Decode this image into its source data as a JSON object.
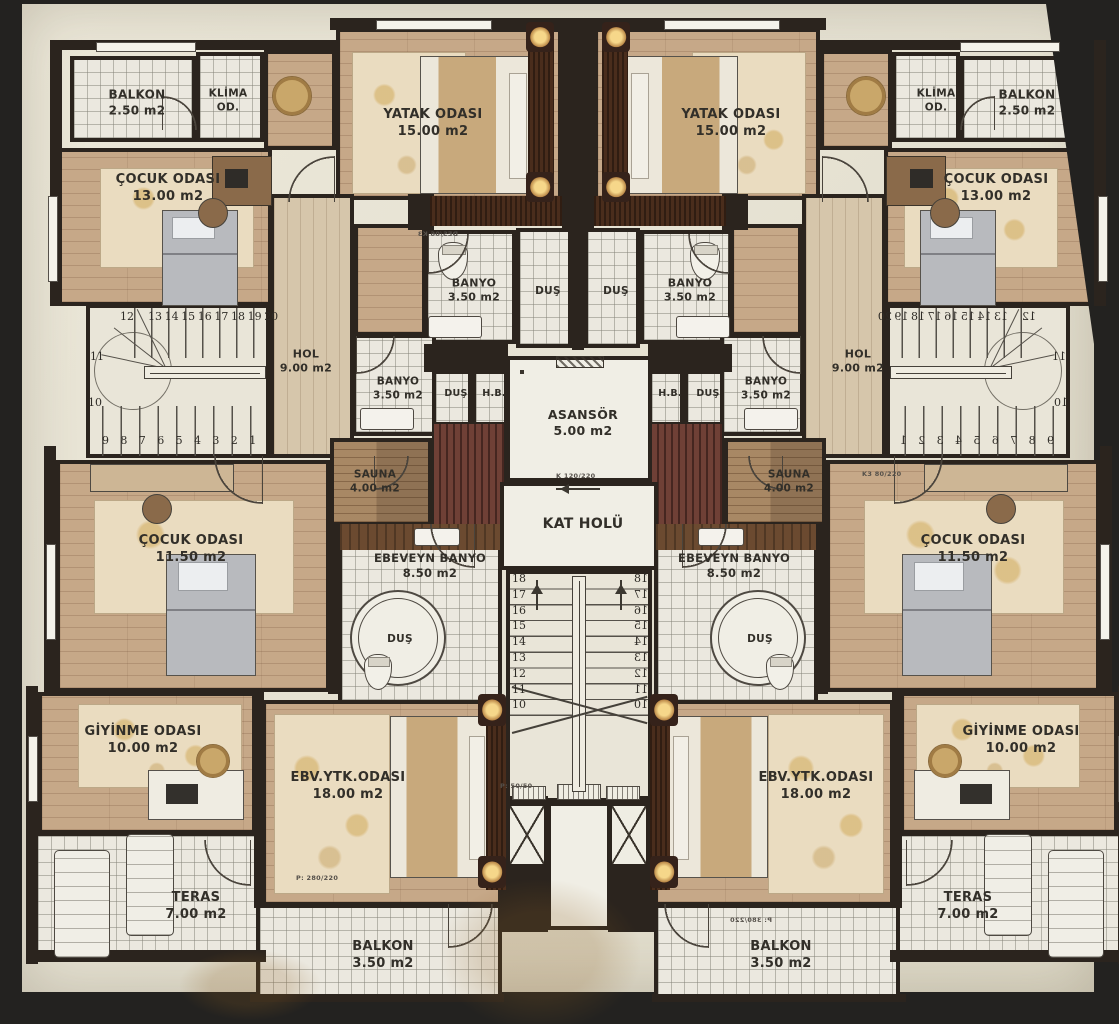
{
  "title": "Apartman Kat Planı (Duplex Floor Plan)",
  "colors": {
    "background": "#232220",
    "paper": "#e6e2d3",
    "wall": "#2b241e",
    "wood_floor": "#c6a888",
    "tile_floor": "#ebe8df",
    "entry_carpet": "#6f4036",
    "rug": "#eadcc0"
  },
  "plan": {
    "rooms": [
      {
        "id": "yatak-odasi",
        "side": "b",
        "lines": [
          "YATAK ODASI",
          "15.00 m2"
        ],
        "x": 336,
        "y": 28,
        "w": 226,
        "h": 172,
        "f": "wood",
        "ldx": -20,
        "ldy": 6
      },
      {
        "id": "wood-nook",
        "side": "b",
        "lines": [],
        "x": 264,
        "y": 50,
        "w": 72,
        "h": 100,
        "f": "wood"
      },
      {
        "id": "balkon-ust",
        "side": "b",
        "lines": [
          "BALKON",
          "2.50 m2"
        ],
        "x": 70,
        "y": 56,
        "w": 126,
        "h": 86,
        "f": "tile",
        "fs": 12
      },
      {
        "id": "klima-odasi",
        "side": "b",
        "lines": [
          "KLİMA",
          "OD."
        ],
        "x": 196,
        "y": 52,
        "w": 68,
        "h": 90,
        "f": "tile",
        "fs": 10.5,
        "ldx": -6
      },
      {
        "id": "cocuk-odasi-13",
        "side": "b",
        "lines": [
          "ÇOCUK ODASI",
          "13.00 m2"
        ],
        "x": 56,
        "y": 148,
        "w": 216,
        "h": 158,
        "f": "wood",
        "ldy": -42
      },
      {
        "id": "hol",
        "side": "b",
        "lines": [
          "HOL",
          "9.00 m2"
        ],
        "x": 270,
        "y": 194,
        "w": 84,
        "h": 264,
        "f": "woodv",
        "fs": 11,
        "ldx": -10,
        "ldy": 32
      },
      {
        "id": "wood-pass",
        "side": "b",
        "lines": [],
        "x": 354,
        "y": 224,
        "w": 72,
        "h": 112,
        "f": "wood"
      },
      {
        "id": "merdiven",
        "side": "b",
        "lines": [],
        "x": 86,
        "y": 304,
        "w": 184,
        "h": 154,
        "f": "stair",
        "sp": "sidestair"
      },
      {
        "id": "banyo-ust",
        "side": "b",
        "lines": [
          "BANYO",
          "3.50 m2"
        ],
        "x": 424,
        "y": 230,
        "w": 92,
        "h": 114,
        "f": "tile",
        "fs": 11
      },
      {
        "id": "dus-ust",
        "side": "b",
        "lines": [
          "DUŞ"
        ],
        "x": 516,
        "y": 228,
        "w": 56,
        "h": 120,
        "f": "tile",
        "fs": 10.5
      },
      {
        "id": "banyo-orta",
        "side": "b",
        "lines": [
          "BANYO",
          "3.50 m2"
        ],
        "x": 352,
        "y": 334,
        "w": 84,
        "h": 102,
        "f": "tile",
        "fs": 10.5
      },
      {
        "id": "dus-kucuk",
        "side": "b",
        "lines": [
          "DUŞ"
        ],
        "x": 432,
        "y": 370,
        "w": 40,
        "h": 68,
        "f": "tile",
        "fs": 9.5,
        "ldy": -14
      },
      {
        "id": "hb",
        "side": "b",
        "lines": [
          "H.B."
        ],
        "x": 472,
        "y": 370,
        "w": 36,
        "h": 68,
        "f": "tile",
        "fs": 9.5,
        "ldy": -14
      },
      {
        "id": "sauna",
        "side": "b",
        "lines": [
          "SAUNA",
          "4.00 m2"
        ],
        "x": 330,
        "y": 438,
        "w": 102,
        "h": 88,
        "f": "sauna",
        "fs": 10.5,
        "ldx": -10,
        "ldy": -4
      },
      {
        "id": "giris-halisi",
        "side": "b",
        "lines": [],
        "x": 432,
        "y": 422,
        "w": 74,
        "h": 104,
        "f": "red"
      },
      {
        "id": "cocuk-odasi-115",
        "side": "b",
        "lines": [
          "ÇOCUK ODASI",
          "11.50 m2"
        ],
        "x": 56,
        "y": 460,
        "w": 274,
        "h": 232,
        "f": "wood",
        "ldx": -6,
        "ldy": -30
      },
      {
        "id": "ebeveyn-banyo",
        "side": "b",
        "lines": [
          "EBEVEYN BANYO",
          "8.50 m2"
        ],
        "x": 338,
        "y": 524,
        "w": 164,
        "h": 180,
        "f": "tile",
        "fs": 11.5,
        "ldx": 6,
        "ldy": -52
      },
      {
        "id": "giyinme-odasi",
        "side": "b",
        "lines": [
          "GİYİNME ODASI",
          "10.00 m2"
        ],
        "x": 38,
        "y": 692,
        "w": 218,
        "h": 142,
        "f": "wood",
        "ldx": -8,
        "ldy": -26
      },
      {
        "id": "ebv-ytk-odasi",
        "side": "b",
        "lines": [
          "EBV.YTK.ODASI",
          "18.00 m2"
        ],
        "x": 262,
        "y": 700,
        "w": 240,
        "h": 206,
        "f": "wood",
        "ldx": -38,
        "ldy": -20
      },
      {
        "id": "teras",
        "side": "b",
        "lines": [
          "TERAS",
          "7.00 m2"
        ],
        "x": 34,
        "y": 832,
        "w": 228,
        "h": 126,
        "f": "tile",
        "ldx": 44,
        "ldy": 8
      },
      {
        "id": "balkon-alt",
        "side": "b",
        "lines": [
          "BALKON",
          "3.50 m2"
        ],
        "x": 256,
        "y": 904,
        "w": 246,
        "h": 96,
        "f": "tile"
      },
      {
        "id": "asansor",
        "side": "c",
        "lines": [
          "ASANSÖR",
          "5.00 m2"
        ],
        "x": 506,
        "y": 356,
        "w": 146,
        "h": 126,
        "f": "white",
        "sp": "elevator",
        "fs": 12.5
      },
      {
        "id": "kat-holu",
        "side": "c",
        "lines": [
          "KAT HOLÜ"
        ],
        "x": 500,
        "y": 482,
        "w": 158,
        "h": 88,
        "f": "white",
        "fs": 14,
        "ldy": -6
      },
      {
        "id": "merkez-merdiven",
        "side": "c",
        "lines": [],
        "x": 506,
        "y": 570,
        "w": 146,
        "h": 232,
        "f": "stair",
        "sp": "centerstair"
      },
      {
        "id": "orta-koridor",
        "side": "c",
        "lines": [],
        "x": 547,
        "y": 802,
        "w": 64,
        "h": 128,
        "f": "white"
      },
      {
        "id": "dus-yuvarlak",
        "side": "b",
        "lines": [
          "DUŞ"
        ],
        "x": 350,
        "y": 590,
        "w": 96,
        "h": 96,
        "f": "white",
        "round": true,
        "fs": 10.5
      }
    ],
    "side_stairs": {
      "top_row": [
        "12",
        "13",
        "14",
        "15",
        "16",
        "17",
        "18",
        "19",
        "20"
      ],
      "mid": [
        "11",
        "10"
      ],
      "bottom_row": [
        "9",
        "8",
        "7",
        "6",
        "5",
        "4",
        "3",
        "2",
        "1"
      ]
    },
    "center_stairs": {
      "numbers": [
        "18",
        "17",
        "16",
        "15",
        "14",
        "13",
        "12",
        "11",
        "10"
      ]
    },
    "door_specs": [
      {
        "text": "P: 280/220",
        "x": 296,
        "y": 874
      },
      {
        "text": "P: 380/220",
        "x": 712,
        "y": 916,
        "mirrored": true
      },
      {
        "text": "DES/06 K3",
        "x": 398,
        "y": 230,
        "mirrored": true
      },
      {
        "text": "K3 80/220",
        "x": 862,
        "y": 470
      },
      {
        "text": "K 120/220",
        "x": 556,
        "y": 472
      },
      {
        "text": "P: 50/50",
        "x": 500,
        "y": 782
      }
    ]
  }
}
